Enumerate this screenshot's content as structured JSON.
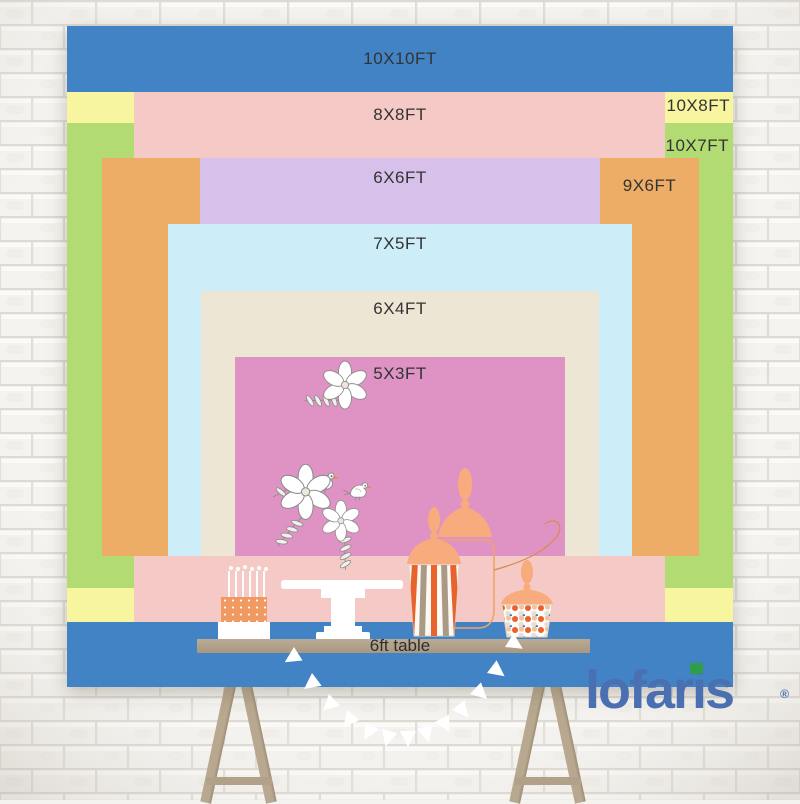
{
  "title": "Backdrop size comparison chart",
  "layers": [
    {
      "id": "10x10",
      "label": "10X10FT",
      "color": "#4183c5",
      "width_ft": 10,
      "height_ft": 10
    },
    {
      "id": "10x8",
      "label": "10X8FT",
      "color": "#f8f5a0",
      "width_ft": 10,
      "height_ft": 8
    },
    {
      "id": "10x7",
      "label": "10X7FT",
      "color": "#b2dc73",
      "width_ft": 10,
      "height_ft": 7
    },
    {
      "id": "8x8",
      "label": "8X8FT",
      "color": "#f5c9c5",
      "width_ft": 8,
      "height_ft": 8
    },
    {
      "id": "9x6",
      "label": "9X6FT",
      "color": "#eead66",
      "width_ft": 9,
      "height_ft": 6
    },
    {
      "id": "6x6",
      "label": "6X6FT",
      "color": "#d7c0ea",
      "width_ft": 6,
      "height_ft": 6
    },
    {
      "id": "7x5",
      "label": "7X5FT",
      "color": "#cdeef8",
      "width_ft": 7,
      "height_ft": 5
    },
    {
      "id": "6x4",
      "label": "6X4FT",
      "color": "#eee6d5",
      "width_ft": 6,
      "height_ft": 4
    },
    {
      "id": "5x3",
      "label": "5X3FT",
      "color": "#df93c4",
      "width_ft": 5,
      "height_ft": 3
    }
  ],
  "label_text_color": "#333333",
  "table": {
    "label": "6ft table"
  },
  "brand": {
    "name": "lofaris",
    "name_parts": [
      "lofar",
      "i",
      "s"
    ],
    "registered": "®",
    "color": "#4a70b2",
    "accent_color": "#2f9e49"
  },
  "decorations": {
    "pennant_count": 13,
    "candle_count": 6,
    "cake_tiers": 3
  }
}
